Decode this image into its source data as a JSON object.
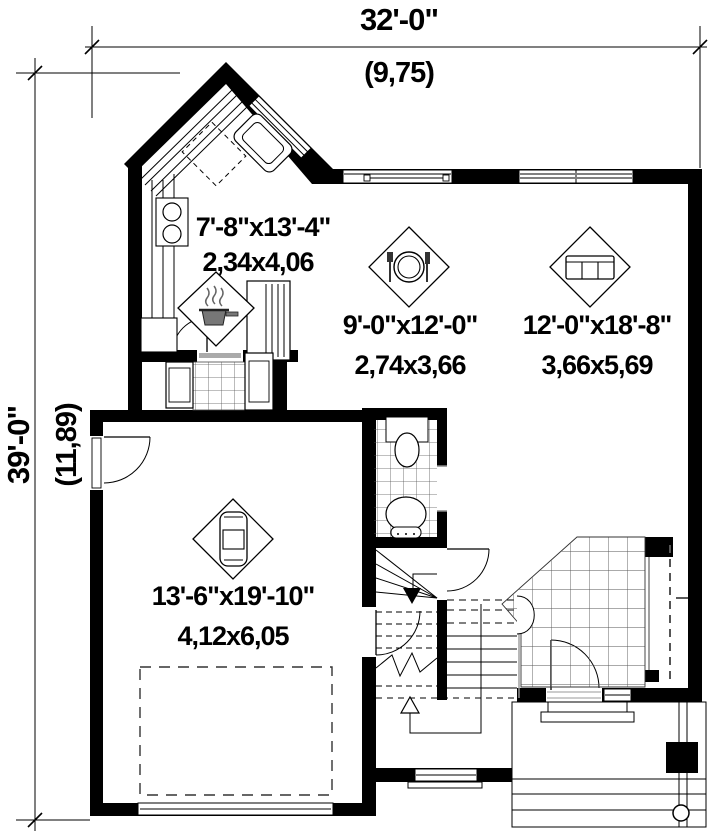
{
  "plan": {
    "title_hint": "first-floor-plan",
    "dimensions": {
      "width_imperial": "32'-0\"",
      "width_metric": "(9,75)",
      "height_imperial": "39'-0\"",
      "height_metric": "(11,89)"
    },
    "rooms": [
      {
        "id": "kitchen",
        "imperial": "7'-8\"x13'-4\"",
        "metric": "2,34x4,06",
        "icon": "stove-pot-icon"
      },
      {
        "id": "dining",
        "imperial": "9'-0\"x12'-0\"",
        "metric": "2,74x3,66",
        "icon": "place-setting-icon"
      },
      {
        "id": "living",
        "imperial": "12'-0\"x18'-8\"",
        "metric": "3,66x5,69",
        "icon": "sofa-icon"
      },
      {
        "id": "garage",
        "imperial": "13'-6\"x19'-10\"",
        "metric": "4,12x6,05",
        "icon": "car-icon"
      }
    ],
    "colors": {
      "wall": "#000000",
      "background": "#ffffff",
      "tile_line": "#555555"
    }
  }
}
